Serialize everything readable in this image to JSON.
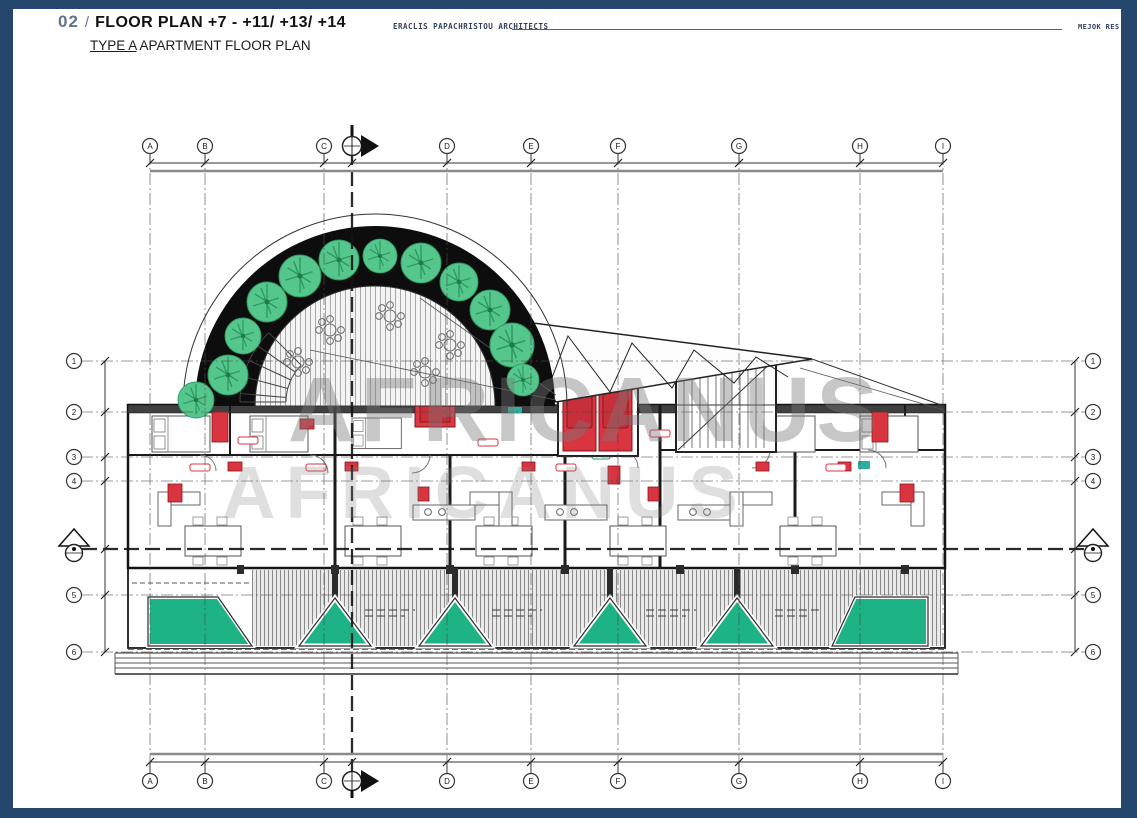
{
  "header": {
    "sheet_no": "02",
    "sep": "/",
    "title": "FLOOR PLAN +7 - +11/ +13/ +14",
    "subtitle_type": "TYPE A",
    "subtitle_rest": " APARTMENT FLOOR PLAN",
    "architect": "ERACLIS PAPACHRISTOU ARCHITECTS",
    "project_ref": "MEJOK RES"
  },
  "watermark": {
    "line1": "AFRICANUS",
    "line2": "AFRICANUS"
  },
  "grid": {
    "columns": [
      "A",
      "B",
      "C",
      "D",
      "E",
      "F",
      "G",
      "H",
      "I"
    ],
    "rows": [
      "1",
      "2",
      "3",
      "4",
      "5",
      "6"
    ]
  },
  "colors": {
    "frame_navy": "#25476d",
    "core_red": "#d93540",
    "tree_green": "#56c78c",
    "planter_green": "#1db387"
  }
}
